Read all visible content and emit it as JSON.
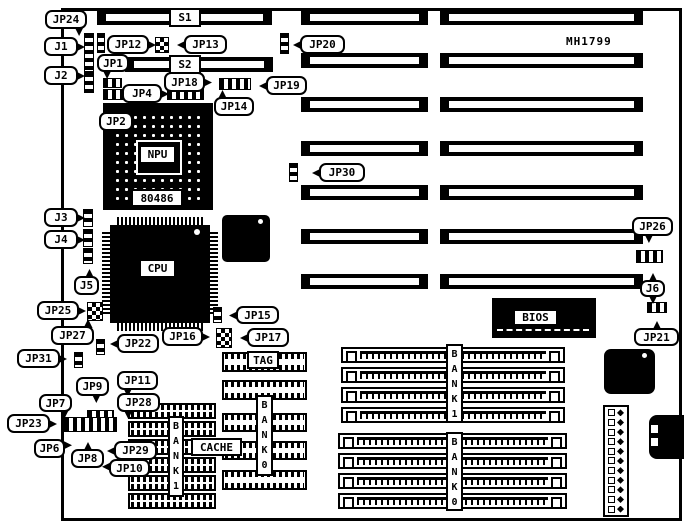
{
  "board_model": "MH1799",
  "colors": {
    "ink": "#000000",
    "paper": "#ffffff"
  },
  "silkscreen_boxes": [
    {
      "id": "s1-label",
      "text": "S1",
      "x": 169,
      "y": 8,
      "w": 32,
      "h": 19
    },
    {
      "id": "s2-label",
      "text": "S2",
      "x": 169,
      "y": 55,
      "w": 32,
      "h": 19
    },
    {
      "id": "npu-label",
      "text": "NPU",
      "x": 139,
      "y": 145,
      "w": 37,
      "h": 19
    },
    {
      "id": "npu-part-label",
      "text": "80486",
      "x": 131,
      "y": 189,
      "w": 52,
      "h": 18
    },
    {
      "id": "cpu-label",
      "text": "CPU",
      "x": 139,
      "y": 259,
      "w": 37,
      "h": 19
    },
    {
      "id": "bios-label",
      "text": "BIOS",
      "x": 513,
      "y": 309,
      "w": 45,
      "h": 17
    },
    {
      "id": "tag-label",
      "text": "TAG",
      "x": 247,
      "y": 351,
      "w": 32,
      "h": 18
    },
    {
      "id": "cache-label",
      "text": "CACHE",
      "x": 191,
      "y": 438,
      "w": 51,
      "h": 18
    }
  ],
  "vertical_labels": [
    {
      "id": "simm-bank1-label",
      "text": "BANK1",
      "x": 446,
      "y": 344,
      "w": 17,
      "h": 79
    },
    {
      "id": "simm-bank0-label",
      "text": "BANK0",
      "x": 446,
      "y": 432,
      "w": 17,
      "h": 79
    },
    {
      "id": "cache-bank1-label",
      "text": "BANK1",
      "x": 168,
      "y": 416,
      "w": 16,
      "h": 81
    },
    {
      "id": "cache-bank0-label",
      "text": "BANK0",
      "x": 256,
      "y": 395,
      "w": 17,
      "h": 81
    }
  ],
  "callouts": [
    {
      "id": "jp24",
      "label": "JP24",
      "x": 45,
      "y": 10,
      "w": 42,
      "h": 19,
      "tails": [
        {
          "s": "b",
          "p": 80
        }
      ]
    },
    {
      "id": "j1",
      "label": "J1",
      "x": 44,
      "y": 37,
      "w": 34,
      "h": 19,
      "tails": [
        {
          "s": "r",
          "p": 50
        }
      ]
    },
    {
      "id": "j2",
      "label": "J2",
      "x": 44,
      "y": 66,
      "w": 34,
      "h": 19,
      "tails": [
        {
          "s": "r",
          "p": 50
        }
      ]
    },
    {
      "id": "jp12",
      "label": "JP12",
      "x": 107,
      "y": 35,
      "w": 42,
      "h": 19,
      "tails": [
        {
          "s": "r",
          "p": 50
        }
      ]
    },
    {
      "id": "jp13",
      "label": "JP13",
      "x": 184,
      "y": 35,
      "w": 43,
      "h": 19,
      "tails": [
        {
          "s": "l",
          "p": 50
        }
      ]
    },
    {
      "id": "jp1",
      "label": "JP1",
      "x": 97,
      "y": 54,
      "w": 32,
      "h": 18,
      "tails": [
        {
          "s": "b",
          "p": 30
        }
      ]
    },
    {
      "id": "jp18",
      "label": "JP18",
      "x": 164,
      "y": 72,
      "w": 41,
      "h": 20,
      "tails": [
        {
          "s": "r",
          "p": 50
        }
      ]
    },
    {
      "id": "jp19",
      "label": "JP19",
      "x": 266,
      "y": 76,
      "w": 41,
      "h": 19,
      "tails": [
        {
          "s": "l",
          "p": 50
        }
      ]
    },
    {
      "id": "jp4",
      "label": "JP4",
      "x": 122,
      "y": 84,
      "w": 40,
      "h": 19,
      "tails": [
        {
          "s": "r",
          "p": 50
        }
      ]
    },
    {
      "id": "jp14",
      "label": "JP14",
      "x": 214,
      "y": 97,
      "w": 40,
      "h": 19,
      "tails": [
        {
          "s": "t",
          "p": 20
        }
      ]
    },
    {
      "id": "jp2",
      "label": "JP2",
      "x": 99,
      "y": 112,
      "w": 34,
      "h": 19,
      "tails": [
        {
          "s": "t",
          "p": 40
        }
      ]
    },
    {
      "id": "jp20",
      "label": "JP20",
      "x": 300,
      "y": 35,
      "w": 45,
      "h": 19,
      "tails": [
        {
          "s": "l",
          "p": 50
        }
      ]
    },
    {
      "id": "jp30",
      "label": "JP30",
      "x": 319,
      "y": 163,
      "w": 46,
      "h": 19,
      "tails": [
        {
          "s": "l",
          "p": 50
        }
      ]
    },
    {
      "id": "j3",
      "label": "J3",
      "x": 44,
      "y": 208,
      "w": 34,
      "h": 19,
      "tails": [
        {
          "s": "r",
          "p": 50
        }
      ]
    },
    {
      "id": "j4",
      "label": "J4",
      "x": 44,
      "y": 230,
      "w": 34,
      "h": 19,
      "tails": [
        {
          "s": "r",
          "p": 50
        }
      ]
    },
    {
      "id": "j5",
      "label": "J5",
      "x": 74,
      "y": 276,
      "w": 25,
      "h": 19,
      "tails": [
        {
          "s": "t",
          "p": 60
        }
      ]
    },
    {
      "id": "jp25",
      "label": "JP25",
      "x": 37,
      "y": 301,
      "w": 42,
      "h": 19,
      "tails": [
        {
          "s": "r",
          "p": 50
        }
      ]
    },
    {
      "id": "jp27",
      "label": "JP27",
      "x": 51,
      "y": 326,
      "w": 43,
      "h": 19,
      "tails": [
        {
          "s": "t",
          "p": 85
        }
      ]
    },
    {
      "id": "jp31",
      "label": "JP31",
      "x": 17,
      "y": 349,
      "w": 43,
      "h": 19,
      "tails": [
        {
          "s": "r",
          "p": 50
        }
      ]
    },
    {
      "id": "jp22",
      "label": "JP22",
      "x": 117,
      "y": 334,
      "w": 42,
      "h": 19,
      "tails": [
        {
          "s": "l",
          "p": 50
        }
      ]
    },
    {
      "id": "jp16",
      "label": "JP16",
      "x": 162,
      "y": 327,
      "w": 41,
      "h": 19,
      "tails": [
        {
          "s": "r",
          "p": 50
        }
      ]
    },
    {
      "id": "jp15",
      "label": "JP15",
      "x": 236,
      "y": 306,
      "w": 43,
      "h": 18,
      "tails": [
        {
          "s": "l",
          "p": 50
        }
      ]
    },
    {
      "id": "jp17",
      "label": "JP17",
      "x": 247,
      "y": 328,
      "w": 42,
      "h": 19,
      "tails": [
        {
          "s": "l",
          "p": 50
        }
      ]
    },
    {
      "id": "jp26",
      "label": "JP26",
      "x": 632,
      "y": 217,
      "w": 41,
      "h": 19,
      "tails": [
        {
          "s": "b",
          "p": 40
        }
      ]
    },
    {
      "id": "j6",
      "label": "J6",
      "x": 640,
      "y": 280,
      "w": 25,
      "h": 17,
      "tails": [
        {
          "s": "t",
          "p": 50
        },
        {
          "s": "b",
          "p": 50
        }
      ]
    },
    {
      "id": "jp21",
      "label": "JP21",
      "x": 634,
      "y": 328,
      "w": 45,
      "h": 18,
      "tails": [
        {
          "s": "t",
          "p": 50
        }
      ]
    },
    {
      "id": "jp9",
      "label": "JP9",
      "x": 76,
      "y": 377,
      "w": 33,
      "h": 19,
      "tails": [
        {
          "s": "b",
          "p": 60
        }
      ]
    },
    {
      "id": "jp11",
      "label": "JP11",
      "x": 117,
      "y": 371,
      "w": 41,
      "h": 19,
      "tails": [
        {
          "s": "b",
          "p": 25
        }
      ]
    },
    {
      "id": "jp7",
      "label": "JP7",
      "x": 39,
      "y": 394,
      "w": 33,
      "h": 18,
      "tails": [
        {
          "s": "b",
          "p": 75
        }
      ]
    },
    {
      "id": "jp28",
      "label": "JP28",
      "x": 117,
      "y": 393,
      "w": 43,
      "h": 19,
      "tails": [
        {
          "s": "b",
          "p": 25
        }
      ]
    },
    {
      "id": "jp23",
      "label": "JP23",
      "x": 7,
      "y": 414,
      "w": 43,
      "h": 19,
      "tails": [
        {
          "s": "r",
          "p": 50
        }
      ]
    },
    {
      "id": "jp6",
      "label": "JP6",
      "x": 34,
      "y": 439,
      "w": 31,
      "h": 19,
      "tails": [
        {
          "s": "r",
          "p": 30
        }
      ]
    },
    {
      "id": "jp8",
      "label": "JP8",
      "x": 71,
      "y": 449,
      "w": 33,
      "h": 19,
      "tails": [
        {
          "s": "t",
          "p": 50
        }
      ]
    },
    {
      "id": "jp29",
      "label": "JP29",
      "x": 114,
      "y": 441,
      "w": 43,
      "h": 19,
      "tails": [
        {
          "s": "l",
          "p": 50
        }
      ]
    },
    {
      "id": "jp10",
      "label": "JP10",
      "x": 109,
      "y": 459,
      "w": 41,
      "h": 18,
      "tails": [
        {
          "s": "l",
          "p": 40
        }
      ]
    }
  ],
  "jumpers": [
    {
      "id": "jp24-pins",
      "x": 97,
      "y": 33,
      "w": 8,
      "h": 20,
      "t": "v"
    },
    {
      "id": "j1-pins",
      "x": 84,
      "y": 33,
      "w": 10,
      "h": 39,
      "t": "v"
    },
    {
      "id": "j2-pins",
      "x": 84,
      "y": 72,
      "w": 10,
      "h": 21,
      "t": "v"
    },
    {
      "id": "jp12-13-pins",
      "x": 155,
      "y": 37,
      "w": 14,
      "h": 16,
      "t": "g"
    },
    {
      "id": "jp1-pins",
      "x": 103,
      "y": 78,
      "w": 19,
      "h": 10,
      "t": "h"
    },
    {
      "id": "jp2-pins",
      "x": 103,
      "y": 89,
      "w": 23,
      "h": 11,
      "t": "h"
    },
    {
      "id": "jp4-14-pins",
      "x": 167,
      "y": 88,
      "w": 37,
      "h": 12,
      "t": "h"
    },
    {
      "id": "jp18-19-pins",
      "x": 219,
      "y": 78,
      "w": 32,
      "h": 12,
      "t": "h"
    },
    {
      "id": "jp20-pins",
      "x": 280,
      "y": 33,
      "w": 9,
      "h": 21,
      "t": "v"
    },
    {
      "id": "jp30-pins",
      "x": 289,
      "y": 163,
      "w": 9,
      "h": 19,
      "t": "v"
    },
    {
      "id": "j3-pins",
      "x": 83,
      "y": 209,
      "w": 10,
      "h": 18,
      "t": "v"
    },
    {
      "id": "j4-pins",
      "x": 83,
      "y": 229,
      "w": 10,
      "h": 18,
      "t": "v"
    },
    {
      "id": "j5-pins",
      "x": 83,
      "y": 248,
      "w": 10,
      "h": 16,
      "t": "v"
    },
    {
      "id": "jp25-pins",
      "x": 87,
      "y": 302,
      "w": 16,
      "h": 19,
      "t": "g"
    },
    {
      "id": "jp22-pins",
      "x": 96,
      "y": 339,
      "w": 9,
      "h": 16,
      "t": "v"
    },
    {
      "id": "jp31-pins",
      "x": 74,
      "y": 352,
      "w": 9,
      "h": 16,
      "t": "v"
    },
    {
      "id": "jp15-pins",
      "x": 213,
      "y": 307,
      "w": 9,
      "h": 16,
      "t": "v"
    },
    {
      "id": "jp16-17-pins",
      "x": 216,
      "y": 328,
      "w": 16,
      "h": 20,
      "t": "g"
    },
    {
      "id": "jp26-pins",
      "x": 636,
      "y": 250,
      "w": 27,
      "h": 13,
      "t": "h"
    },
    {
      "id": "j6-jp21-pins",
      "x": 647,
      "y": 302,
      "w": 20,
      "h": 11,
      "t": "h"
    },
    {
      "id": "jumper-cluster-main",
      "x": 64,
      "y": 417,
      "w": 53,
      "h": 15,
      "t": "h"
    },
    {
      "id": "jumper-cluster-top",
      "x": 87,
      "y": 410,
      "w": 27,
      "h": 8,
      "t": "h"
    }
  ],
  "isa_slots": [
    {
      "x": 301,
      "y": 10,
      "w": 127,
      "h": 15
    },
    {
      "x": 440,
      "y": 10,
      "w": 203,
      "h": 15
    },
    {
      "x": 301,
      "y": 53,
      "w": 127,
      "h": 15
    },
    {
      "x": 440,
      "y": 53,
      "w": 203,
      "h": 15
    },
    {
      "x": 301,
      "y": 97,
      "w": 127,
      "h": 15
    },
    {
      "x": 440,
      "y": 97,
      "w": 203,
      "h": 15
    },
    {
      "x": 301,
      "y": 141,
      "w": 127,
      "h": 15
    },
    {
      "x": 440,
      "y": 141,
      "w": 203,
      "h": 15
    },
    {
      "x": 301,
      "y": 185,
      "w": 127,
      "h": 15
    },
    {
      "x": 440,
      "y": 185,
      "w": 203,
      "h": 15
    },
    {
      "x": 301,
      "y": 229,
      "w": 127,
      "h": 15
    },
    {
      "x": 440,
      "y": 229,
      "w": 203,
      "h": 15
    },
    {
      "x": 301,
      "y": 274,
      "w": 127,
      "h": 15
    },
    {
      "x": 440,
      "y": 274,
      "w": 203,
      "h": 15
    },
    {
      "x": 97,
      "y": 10,
      "w": 175,
      "h": 15
    },
    {
      "x": 125,
      "y": 57,
      "w": 148,
      "h": 15
    }
  ],
  "simm_sockets": [
    {
      "x": 341,
      "y": 347,
      "w": 224,
      "h": 16
    },
    {
      "x": 341,
      "y": 367,
      "w": 224,
      "h": 16
    },
    {
      "x": 341,
      "y": 387,
      "w": 224,
      "h": 16
    },
    {
      "x": 341,
      "y": 407,
      "w": 224,
      "h": 16
    },
    {
      "x": 338,
      "y": 433,
      "w": 229,
      "h": 16
    },
    {
      "x": 338,
      "y": 453,
      "w": 229,
      "h": 16
    },
    {
      "x": 338,
      "y": 473,
      "w": 229,
      "h": 16
    },
    {
      "x": 338,
      "y": 493,
      "w": 229,
      "h": 16
    }
  ],
  "dip_chips": [
    {
      "x": 128,
      "y": 403,
      "w": 88,
      "h": 16
    },
    {
      "x": 128,
      "y": 421,
      "w": 88,
      "h": 16
    },
    {
      "x": 128,
      "y": 439,
      "w": 88,
      "h": 16
    },
    {
      "x": 128,
      "y": 457,
      "w": 88,
      "h": 16
    },
    {
      "x": 128,
      "y": 475,
      "w": 88,
      "h": 16
    },
    {
      "x": 128,
      "y": 493,
      "w": 88,
      "h": 16
    },
    {
      "x": 222,
      "y": 352,
      "w": 85,
      "h": 20
    },
    {
      "x": 222,
      "y": 380,
      "w": 85,
      "h": 20
    },
    {
      "x": 222,
      "y": 413,
      "w": 85,
      "h": 19
    },
    {
      "x": 222,
      "y": 441,
      "w": 85,
      "h": 19
    },
    {
      "x": 222,
      "y": 470,
      "w": 85,
      "h": 20
    }
  ],
  "power_connector_pin_rows": 11
}
